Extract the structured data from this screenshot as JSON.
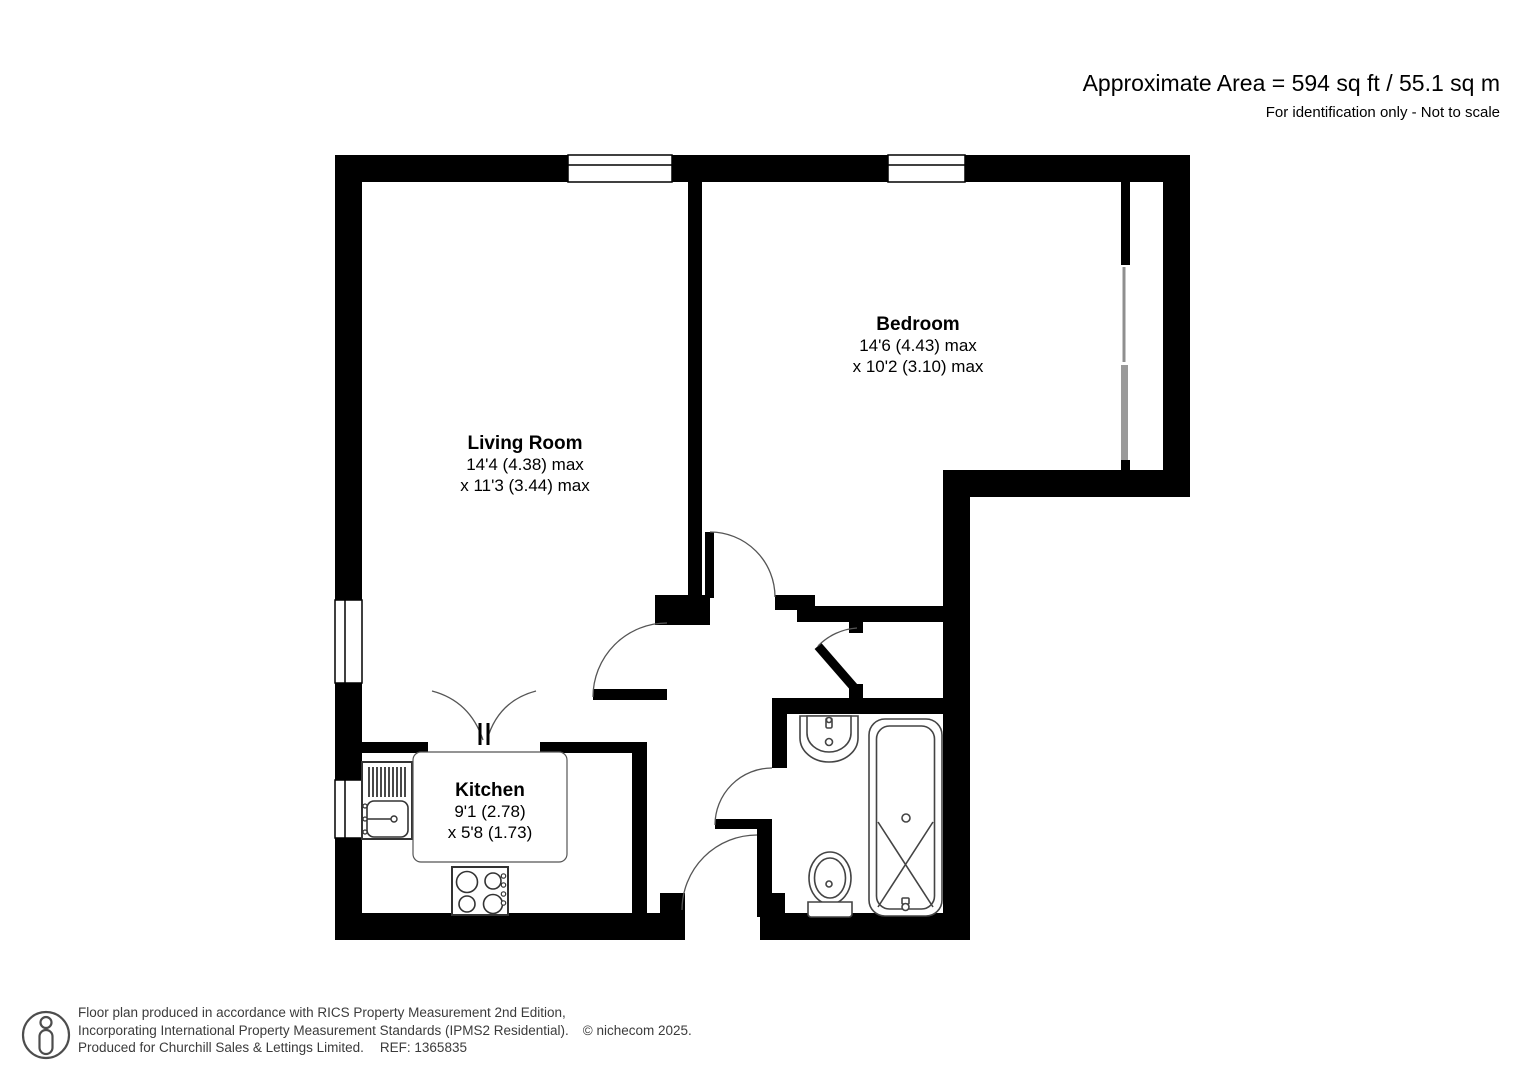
{
  "header": {
    "area_text": "Approximate Area = 594 sq ft / 55.1 sq m",
    "note": "For identification only - Not to scale"
  },
  "rooms": [
    {
      "name": "Living Room",
      "dim1": "14'4 (4.38) max",
      "dim2": "x 11'3 (3.44) max"
    },
    {
      "name": "Bedroom",
      "dim1": "14'6 (4.43) max",
      "dim2": "x 10'2 (3.10) max"
    },
    {
      "name": "Kitchen",
      "dim1": "9'1 (2.78)",
      "dim2": "x 5'8 (1.73)"
    }
  ],
  "footer": {
    "line1": "Floor plan produced in accordance with RICS Property Measurement 2nd Edition,",
    "line2": "Incorporating International Property Measurement Standards (IPMS2 Residential).",
    "copyright": "© nichecom 2025.",
    "line3": "Produced for Churchill Sales & Lettings Limited.",
    "ref": "REF: 1365835"
  },
  "colors": {
    "wall": "#000000",
    "sliding_door_gray": "#8f8f8f",
    "footer_text": "#3b3b3b"
  }
}
